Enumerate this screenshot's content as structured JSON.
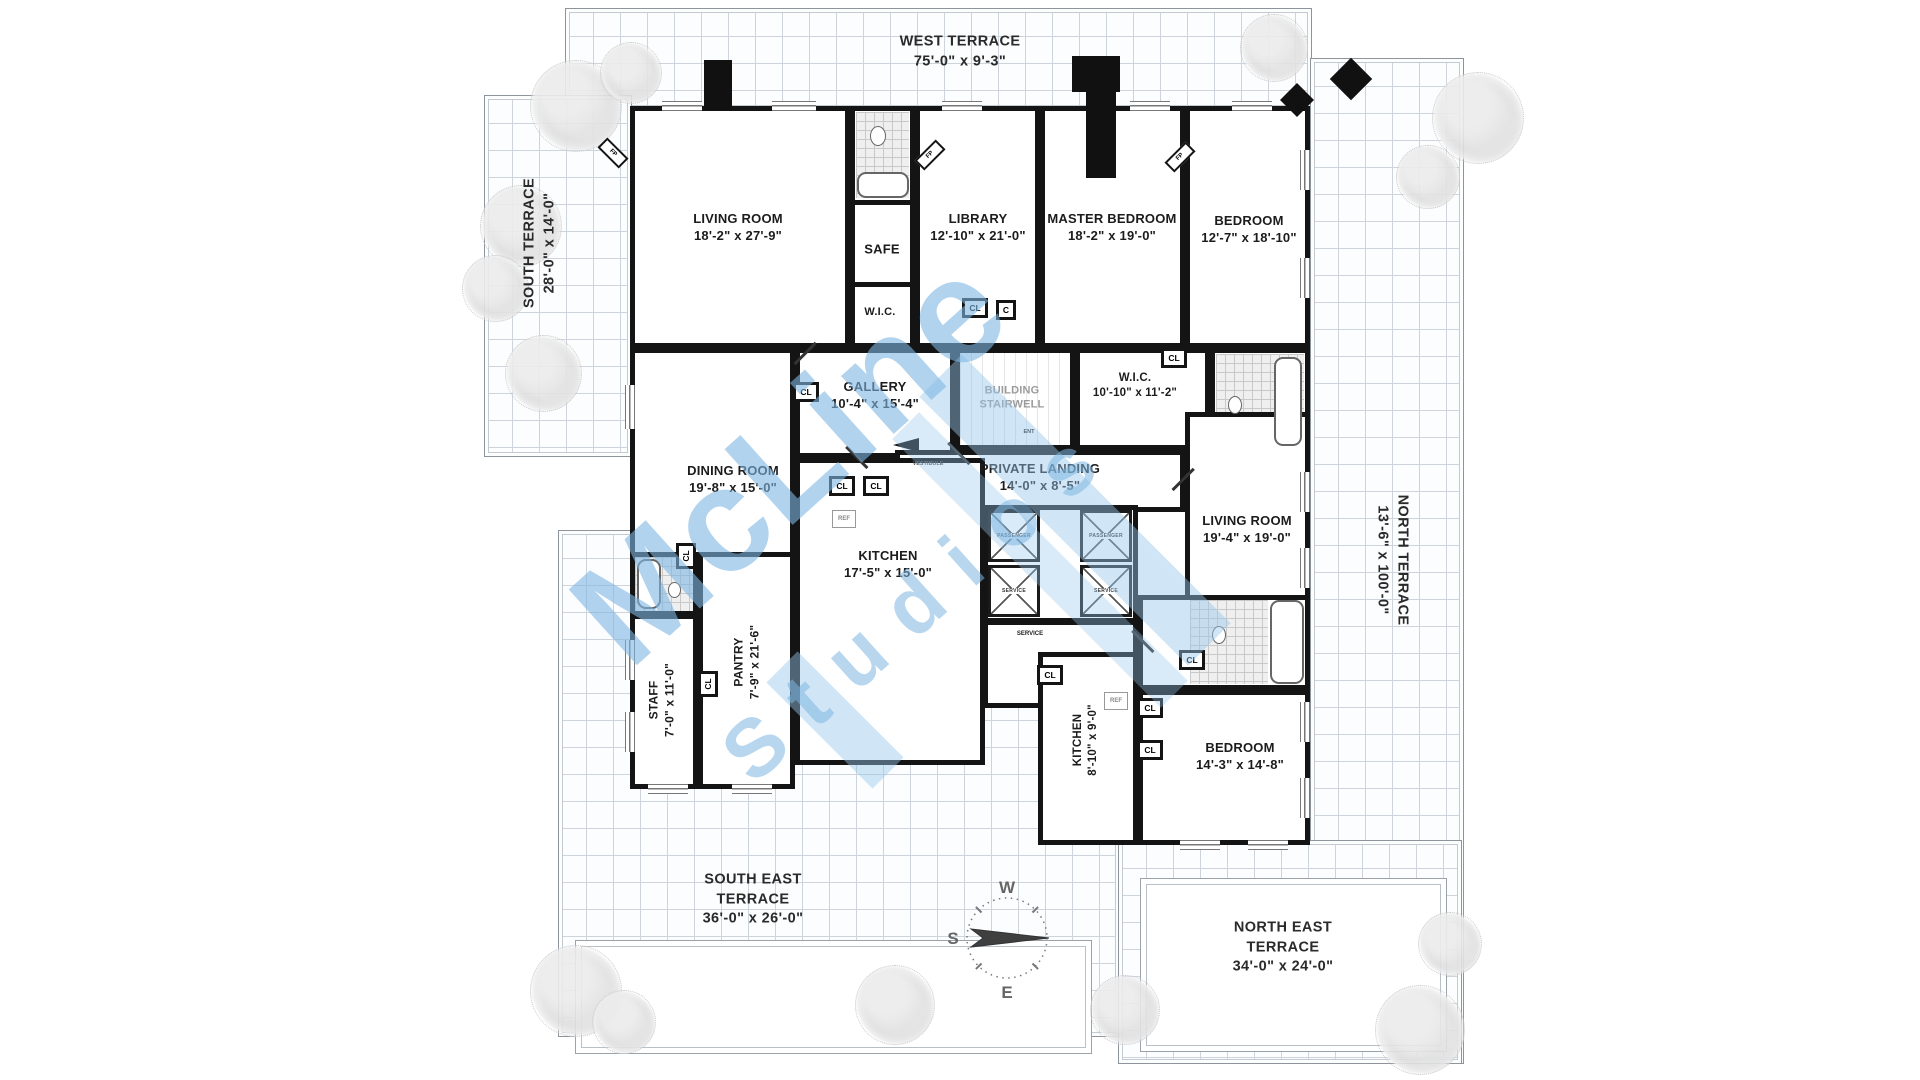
{
  "title": "Penthouse Floor Plan",
  "terraces": {
    "west": {
      "name": "WEST TERRACE",
      "dims": "75'-0\" x 9'-3\""
    },
    "south": {
      "name": "SOUTH TERRACE",
      "dims": "28'-0\" x 14'-0\""
    },
    "north": {
      "name": "NORTH TERRACE",
      "dims": "13'-6\" x 100'-0\""
    },
    "south_east": {
      "name_line1": "SOUTH EAST",
      "name_line2": "TERRACE",
      "dims": "36'-0\" x 26'-0\""
    },
    "north_east": {
      "name_line1": "NORTH EAST",
      "name_line2": "TERRACE",
      "dims": "34'-0\" x 24'-0\""
    }
  },
  "rooms": {
    "living1": {
      "name": "LIVING ROOM",
      "dims": "18'-2\" x 27'-9\""
    },
    "safe": {
      "name": "SAFE"
    },
    "wic_top": {
      "name": "W.I.C."
    },
    "library": {
      "name": "LIBRARY",
      "dims": "12'-10\" x 21'-0\""
    },
    "master": {
      "name": "MASTER BEDROOM",
      "dims": "18'-2\" x 19'-0\""
    },
    "bedroom1": {
      "name": "BEDROOM",
      "dims": "12'-7\" x 18'-10\""
    },
    "gallery": {
      "name": "GALLERY",
      "dims": "10'-4\" x 15'-4\""
    },
    "stairwell": {
      "line1": "BUILDING",
      "line2": "STAIRWELL"
    },
    "wic_mid": {
      "name": "W.I.C.",
      "dims": "10'-10\" x 11'-2\""
    },
    "landing": {
      "name": "PRIVATE LANDING",
      "dims": "14'-0\" x 8'-5\""
    },
    "dining": {
      "name": "DINING ROOM",
      "dims": "19'-8\" x 15'-0\""
    },
    "kitchen1": {
      "name": "KITCHEN",
      "dims": "17'-5\" x 15'-0\""
    },
    "living2": {
      "name": "LIVING ROOM",
      "dims": "19'-4\" x 19'-0\""
    },
    "pantry": {
      "name": "PANTRY",
      "dims": "7'-9\" x 21'-6\""
    },
    "staff": {
      "name": "STAFF",
      "dims": "7'-0\" x 11'-0\""
    },
    "kitchen2": {
      "name": "KITCHEN",
      "dims": "8'-10\" x 9'-0\""
    },
    "bedroom2": {
      "name": "BEDROOM",
      "dims": "14'-3\" x 14'-8\""
    }
  },
  "labels": {
    "cl": "CL",
    "c": "C",
    "ref": "REF",
    "fp": "FP",
    "vestibule": "VESTIBULE",
    "ent": "ENT",
    "service_hall": "SERVICE"
  },
  "elevators": {
    "passenger": "PASSENGER",
    "service": "SERVICE"
  },
  "compass": {
    "west": "W",
    "south": "S",
    "east": "E"
  },
  "watermark": {
    "line1": "McLine",
    "line2": "Studios"
  },
  "colors": {
    "wall": "#141414",
    "grid": "#cdd4db",
    "watermark_blue": "#7db6e2"
  }
}
